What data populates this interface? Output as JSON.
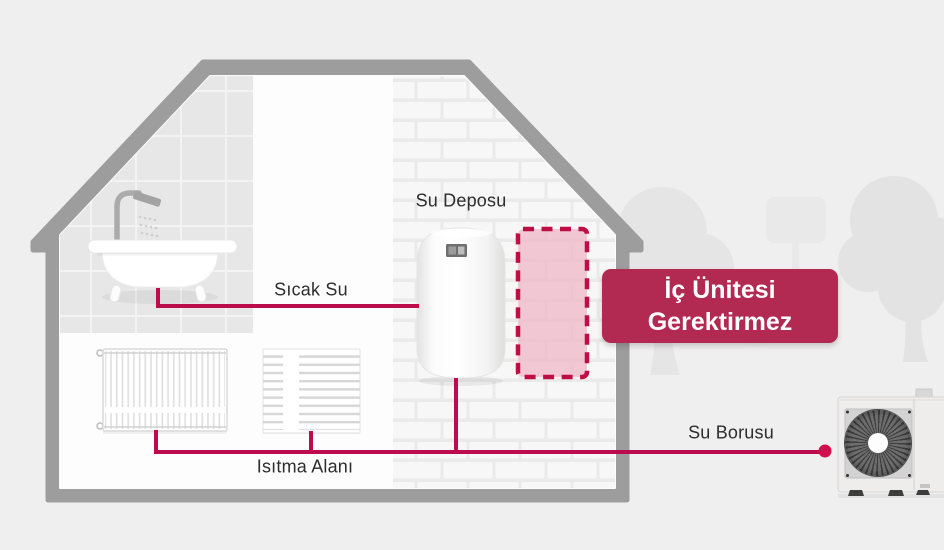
{
  "diagram": {
    "labels": {
      "water_tank": "Su Deposu",
      "hot_water": "Sıcak Su",
      "heating_area": "Isıtma Alanı",
      "water_pipe": "Su Borusu"
    },
    "badge": {
      "line1": "İç Ünitesi",
      "line2": "Gerektirmez"
    },
    "colors": {
      "background": "#f0efef",
      "house_outline": "#9d9d9d",
      "accent_pipe": "#bc0c4b",
      "pipe_dot": "#d10f4c",
      "badge_bg": "#b22a52",
      "placeholder_border": "#bf0e44",
      "placeholder_fill": "#eebccb",
      "label_color": "#2d2d2d"
    }
  }
}
